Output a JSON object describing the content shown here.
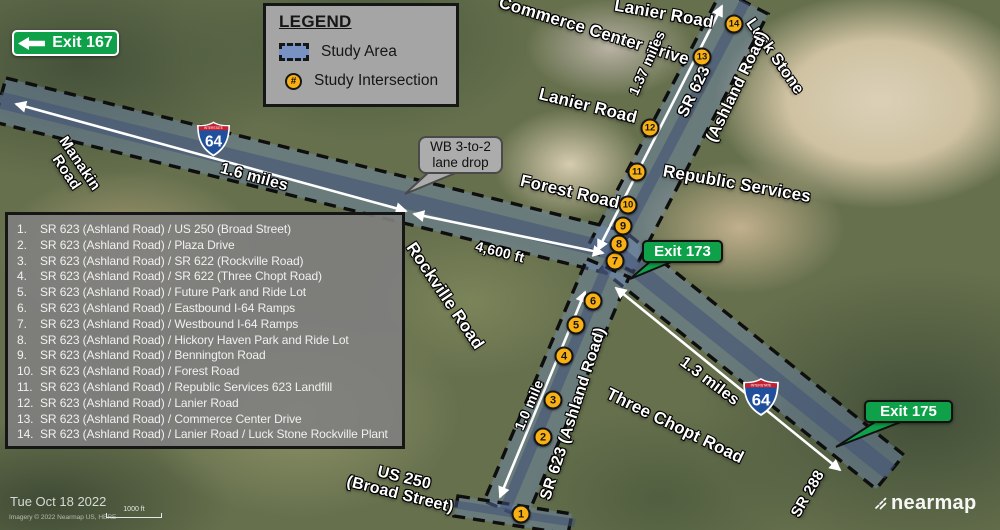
{
  "legend": {
    "title": "LEGEND",
    "study_area_label": "Study Area",
    "study_intersection_label": "Study Intersection",
    "intersection_symbol": "#"
  },
  "exits": {
    "exit167": "Exit 167",
    "exit173": "Exit 173",
    "exit175": "Exit 175"
  },
  "callout": {
    "line1": "WB 3-to-2",
    "line2": "lane drop"
  },
  "intersections": [
    {
      "num": "1.",
      "name": "SR 623 (Ashland Road) / US 250 (Broad Street)"
    },
    {
      "num": "2.",
      "name": "SR 623 (Ashland Road) / Plaza Drive"
    },
    {
      "num": "3.",
      "name": "SR 623 (Ashland Road) / SR 622 (Rockville Road)"
    },
    {
      "num": "4.",
      "name": "SR 623 (Ashland Road) / SR 622 (Three Chopt Road)"
    },
    {
      "num": "5.",
      "name": "SR 623 (Ashland Road) / Future Park and Ride Lot"
    },
    {
      "num": "6.",
      "name": "SR 623 (Ashland Road) / Eastbound I-64 Ramps"
    },
    {
      "num": "7.",
      "name": "SR 623 (Ashland Road) / Westbound I-64 Ramps"
    },
    {
      "num": "8.",
      "name": "SR 623 (Ashland Road) / Hickory Haven Park and Ride Lot"
    },
    {
      "num": "9.",
      "name": "SR 623 (Ashland Road) / Bennington Road"
    },
    {
      "num": "10.",
      "name": "SR 623 (Ashland Road) / Forest Road"
    },
    {
      "num": "11.",
      "name": "SR 623 (Ashland Road) / Republic Services 623 Landfill"
    },
    {
      "num": "12.",
      "name": "SR 623 (Ashland Road) / Lanier Road"
    },
    {
      "num": "13.",
      "name": "SR 623 (Ashland Road) / Commerce Center Drive"
    },
    {
      "num": "14.",
      "name": "SR 623 (Ashland Road) / Lanier Road / Luck Stone Rockville Plant"
    }
  ],
  "markers": [
    "1",
    "2",
    "3",
    "4",
    "5",
    "6",
    "7",
    "8",
    "9",
    "10",
    "11",
    "12",
    "13",
    "14"
  ],
  "road_labels": [
    {
      "id": "manakin",
      "text": "Manakin\nRoad"
    },
    {
      "id": "lanier-top",
      "text": "Lanier Road"
    },
    {
      "id": "commerce",
      "text": "Commerce Center Drive"
    },
    {
      "id": "lanier-mid",
      "text": "Lanier Road"
    },
    {
      "id": "luck-stone",
      "text": "Luck Stone"
    },
    {
      "id": "sr623-top",
      "text": "SR 623"
    },
    {
      "id": "ashland-top",
      "text": "(Ashland Road)"
    },
    {
      "id": "republic",
      "text": "Republic Services"
    },
    {
      "id": "forest",
      "text": "Forest Road"
    },
    {
      "id": "rockville",
      "text": "Rockville Road"
    },
    {
      "id": "sr623-mid",
      "text": "SR 623 (Ashland Road)"
    },
    {
      "id": "three-chopt",
      "text": "Three Chopt Road"
    },
    {
      "id": "us250",
      "text": "US 250\n(Broad Street)"
    },
    {
      "id": "sr288",
      "text": "SR 288"
    }
  ],
  "distance_labels": [
    {
      "id": "d-16mi",
      "text": "1.6 miles"
    },
    {
      "id": "d-4600ft",
      "text": "4,600 ft"
    },
    {
      "id": "d-137mi",
      "text": "1.37 miles"
    },
    {
      "id": "d-10mi",
      "text": "1.0 mile"
    },
    {
      "id": "d-13mi",
      "text": "1.3 miles"
    }
  ],
  "shield": {
    "band": "INTERSTATE",
    "number": "64"
  },
  "footer": {
    "date": "Tue Oct 18 2022",
    "credit": "Imagery © 2022 Nearmap US, HERE",
    "scale_label": "1000 ft",
    "watermark": "nearmap"
  },
  "colors": {
    "exit_green": "#0FA149",
    "marker": "#F9B013",
    "study_area_fill": "#708FC8"
  }
}
